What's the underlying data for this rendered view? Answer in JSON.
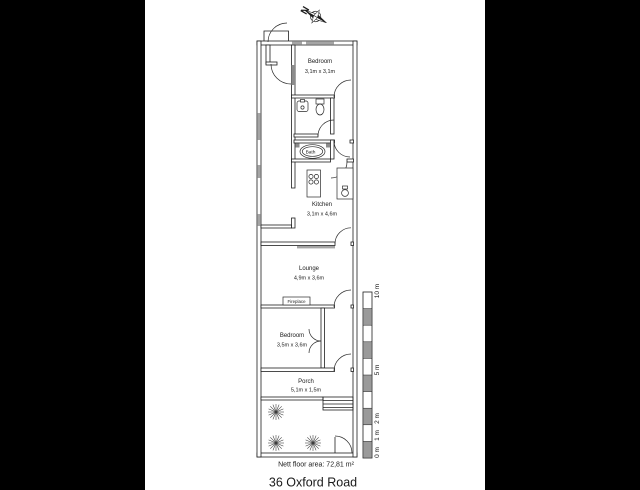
{
  "title": "36 Oxford Road",
  "area_note": "Nett floor area: 72,81 m²",
  "compass": {
    "label": "N"
  },
  "rooms": {
    "bedroom1": {
      "name": "Bedroom",
      "dims": "3,1m x 3,1m"
    },
    "bath": {
      "name": "Bath"
    },
    "kitchen": {
      "name": "Kitchen",
      "dims": "3,1m x 4,6m"
    },
    "lounge": {
      "name": "Lounge",
      "dims": "4,9m x 3,6m"
    },
    "fireplace": {
      "label": "Fireplace"
    },
    "bedroom2": {
      "name": "Bedroom",
      "dims": "3,5m x 3,6m"
    },
    "porch": {
      "name": "Porch",
      "dims": "5,1m x 1,5m"
    }
  },
  "scale_bar": {
    "labels": [
      "0 m",
      "1 m",
      "2 m",
      "5 m",
      "10 m"
    ]
  },
  "colors": {
    "wall": "#1f1f1f",
    "window_gray": "#a5a5a5",
    "inner_window_gray": "#8c8c8c",
    "scale_gray": "#9a9a9a",
    "paper": "#ffffff",
    "letterbox": "#000000"
  }
}
